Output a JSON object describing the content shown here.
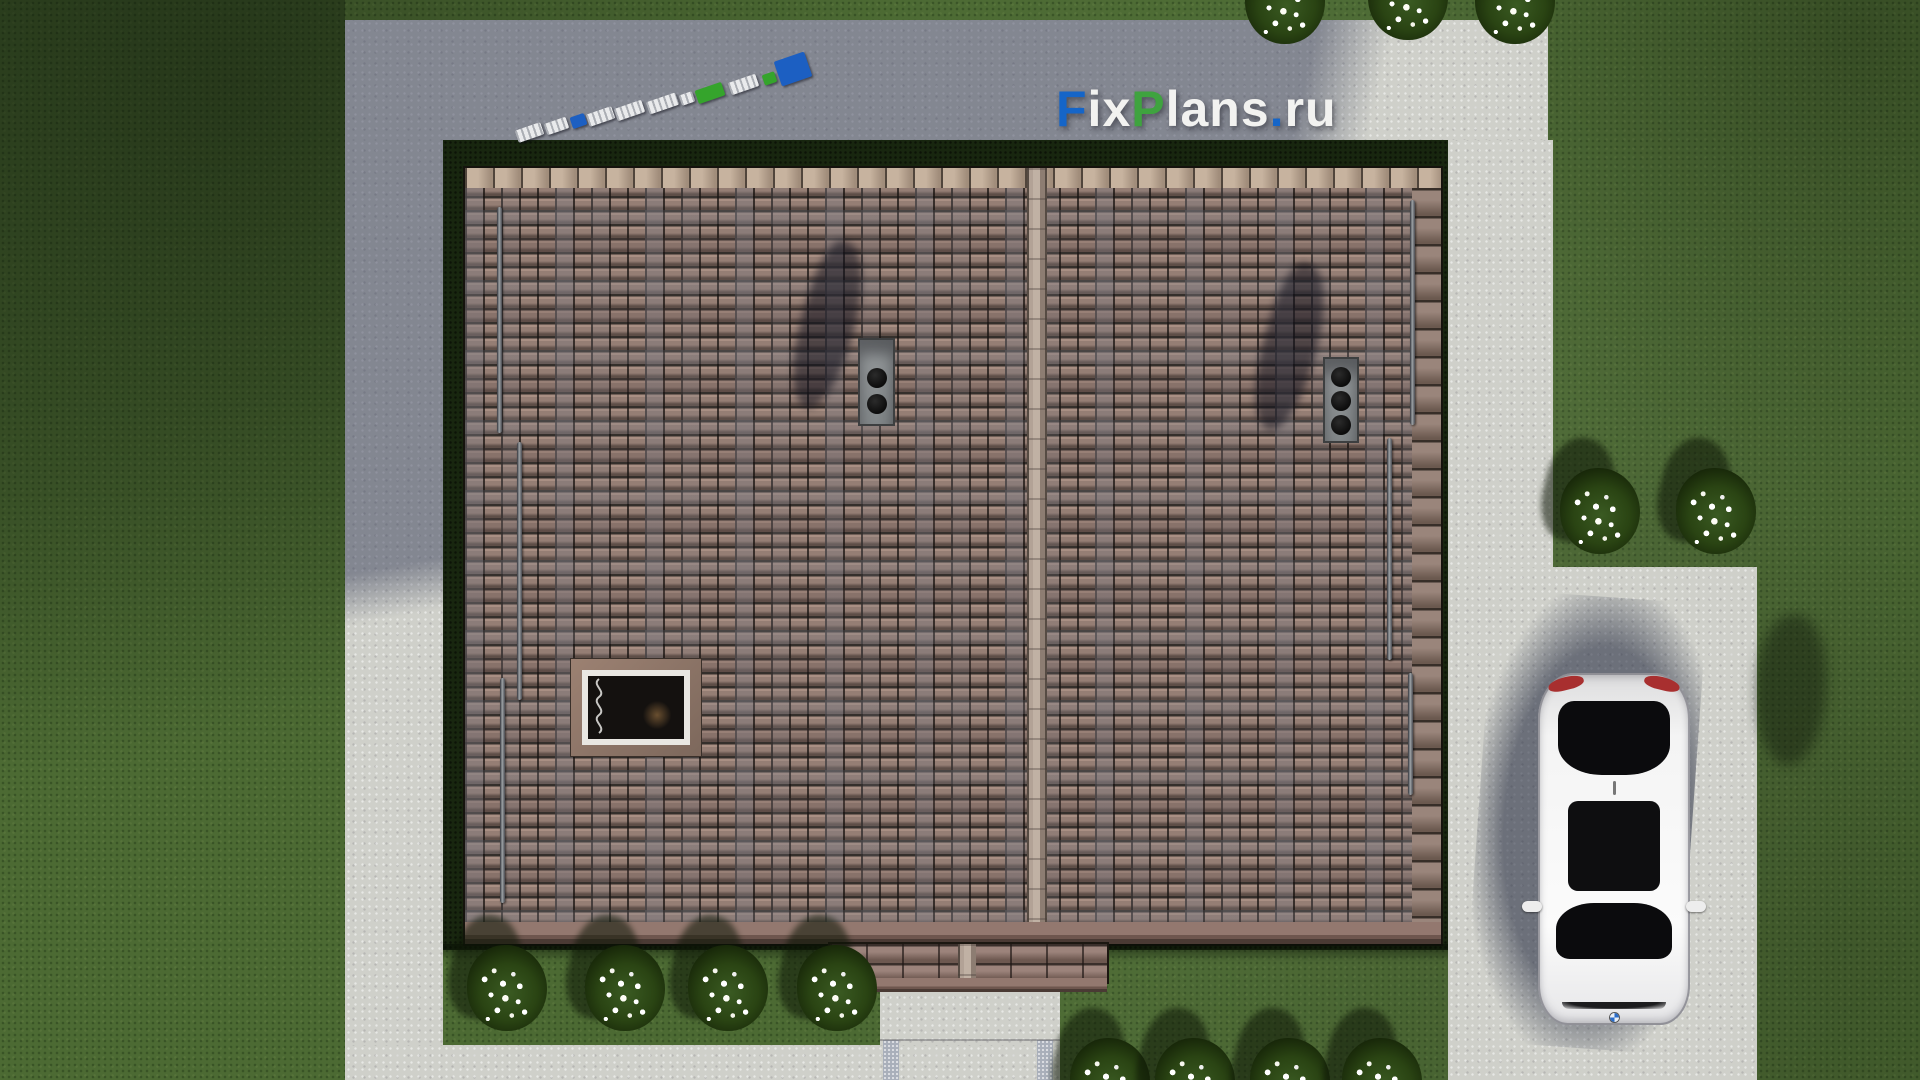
{
  "watermark": {
    "text": "FixPlans.ru",
    "parts": [
      {
        "text": "F",
        "color": "#1565c8"
      },
      {
        "text": "ix",
        "color": "#f2f2f0"
      },
      {
        "text": "P",
        "color": "#3fa33f"
      },
      {
        "text": "lans",
        "color": "#f2f2f0"
      },
      {
        "text": ".",
        "color": "#1565c8"
      },
      {
        "text": "ru",
        "color": "#f2f2f0"
      }
    ]
  },
  "scene": {
    "type": "aerial-3d-render-of-house-roof-plan",
    "objects": [
      "tiled gable roof with central vertical ridge",
      "two gray chimneys with round flues (2 and 3 flues)",
      "dark roof skylight window with white frame",
      "snow-guard bars on both roof slopes",
      "small porch roof at bottom center",
      "concrete paths surrounding house",
      "concrete parking pad with white sedan facing down, red taillights, black sunroof",
      "diagonal run of white/blue/green toy blocks on upper path",
      "white-flower bushes along lawn edges",
      "large house shadow cast to upper-left over concrete"
    ],
    "colors": {
      "grass": "#4c6a33",
      "concrete_lit": "#cfd0ca",
      "concrete_shadowed": "#8b90a0",
      "roof_tile_brown": "#957e74",
      "roof_tile_gray": "#7c7980",
      "ridge_cap_beige": "#c0b1a4",
      "eave_mauve": "#93786f",
      "hedge_dark_green": "#18260f",
      "car_body": "#f4f4f4",
      "taillight_red": "#a82f2f",
      "logo_blue": "#1565c8",
      "logo_green": "#3fa33f"
    }
  }
}
